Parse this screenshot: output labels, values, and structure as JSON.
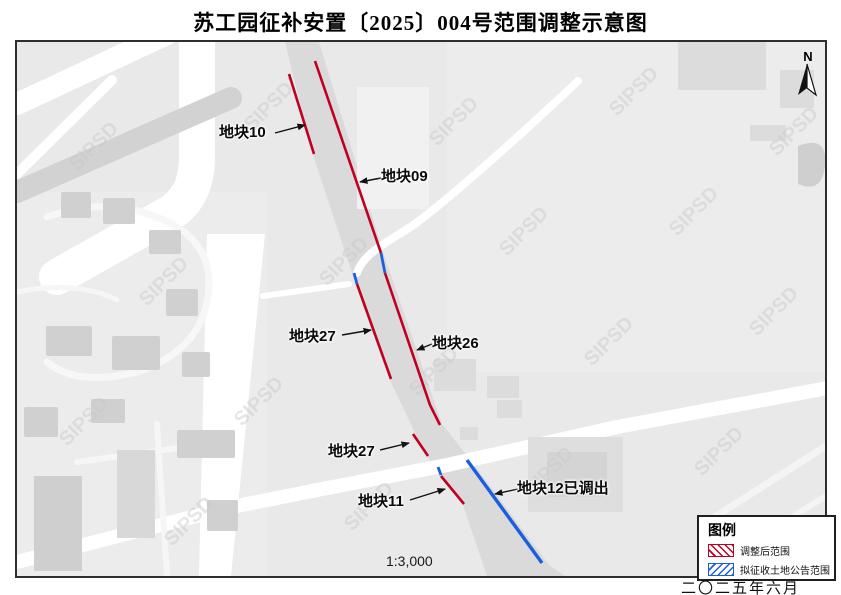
{
  "title": "苏工园征补安置〔2025〕004号范围调整示意图",
  "map": {
    "watermark": "SIPSD",
    "north_label": "N",
    "scale_text": "1:3,000",
    "labels": {
      "p10": "地块10",
      "p09": "地块09",
      "p27a": "地块27",
      "p26": "地块26",
      "p27b": "地块27",
      "p11": "地块11",
      "p12": "地块12已调出"
    }
  },
  "legend": {
    "title": "图例",
    "items": [
      {
        "label": "调整后范围",
        "color": "#c00021"
      },
      {
        "label": "拟征收土地公告范围",
        "color": "#1a5fe0"
      }
    ]
  },
  "footer": {
    "date_text": "二〇二五年六月"
  },
  "colors": {
    "adjusted_range": "#c00021",
    "proposed_range": "#1a5fe0"
  }
}
